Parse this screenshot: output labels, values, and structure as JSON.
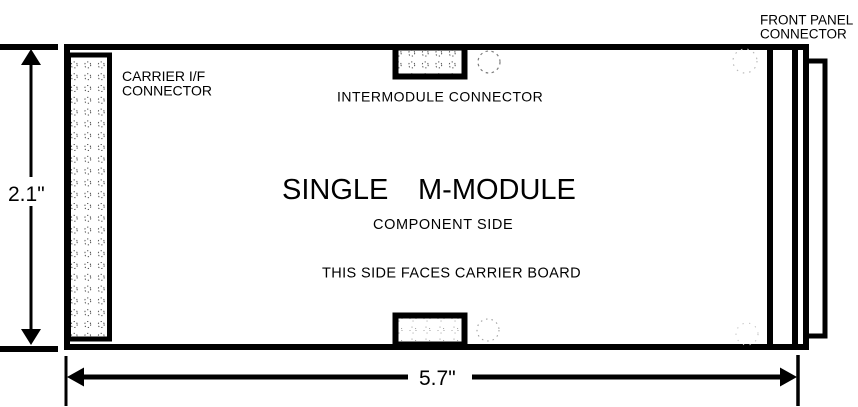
{
  "page": {
    "background_color": "#ffffff",
    "line_color": "#000000"
  },
  "module": {
    "title_word1": "SINGLE",
    "title_word2": "M-MODULE",
    "side_label": "COMPONENT SIDE",
    "orientation_note": "THIS SIDE FACES CARRIER BOARD"
  },
  "connectors": {
    "carrier_if": {
      "label_line1": "CARRIER I/F",
      "label_line2": "CONNECTOR"
    },
    "intermodule": {
      "label": "INTERMODULE CONNECTOR"
    },
    "front_panel": {
      "label_line1": "FRONT PANEL",
      "label_line2": "CONNECTOR"
    }
  },
  "dimensions": {
    "height_label": "2.1\"",
    "width_label": "5.7\""
  }
}
